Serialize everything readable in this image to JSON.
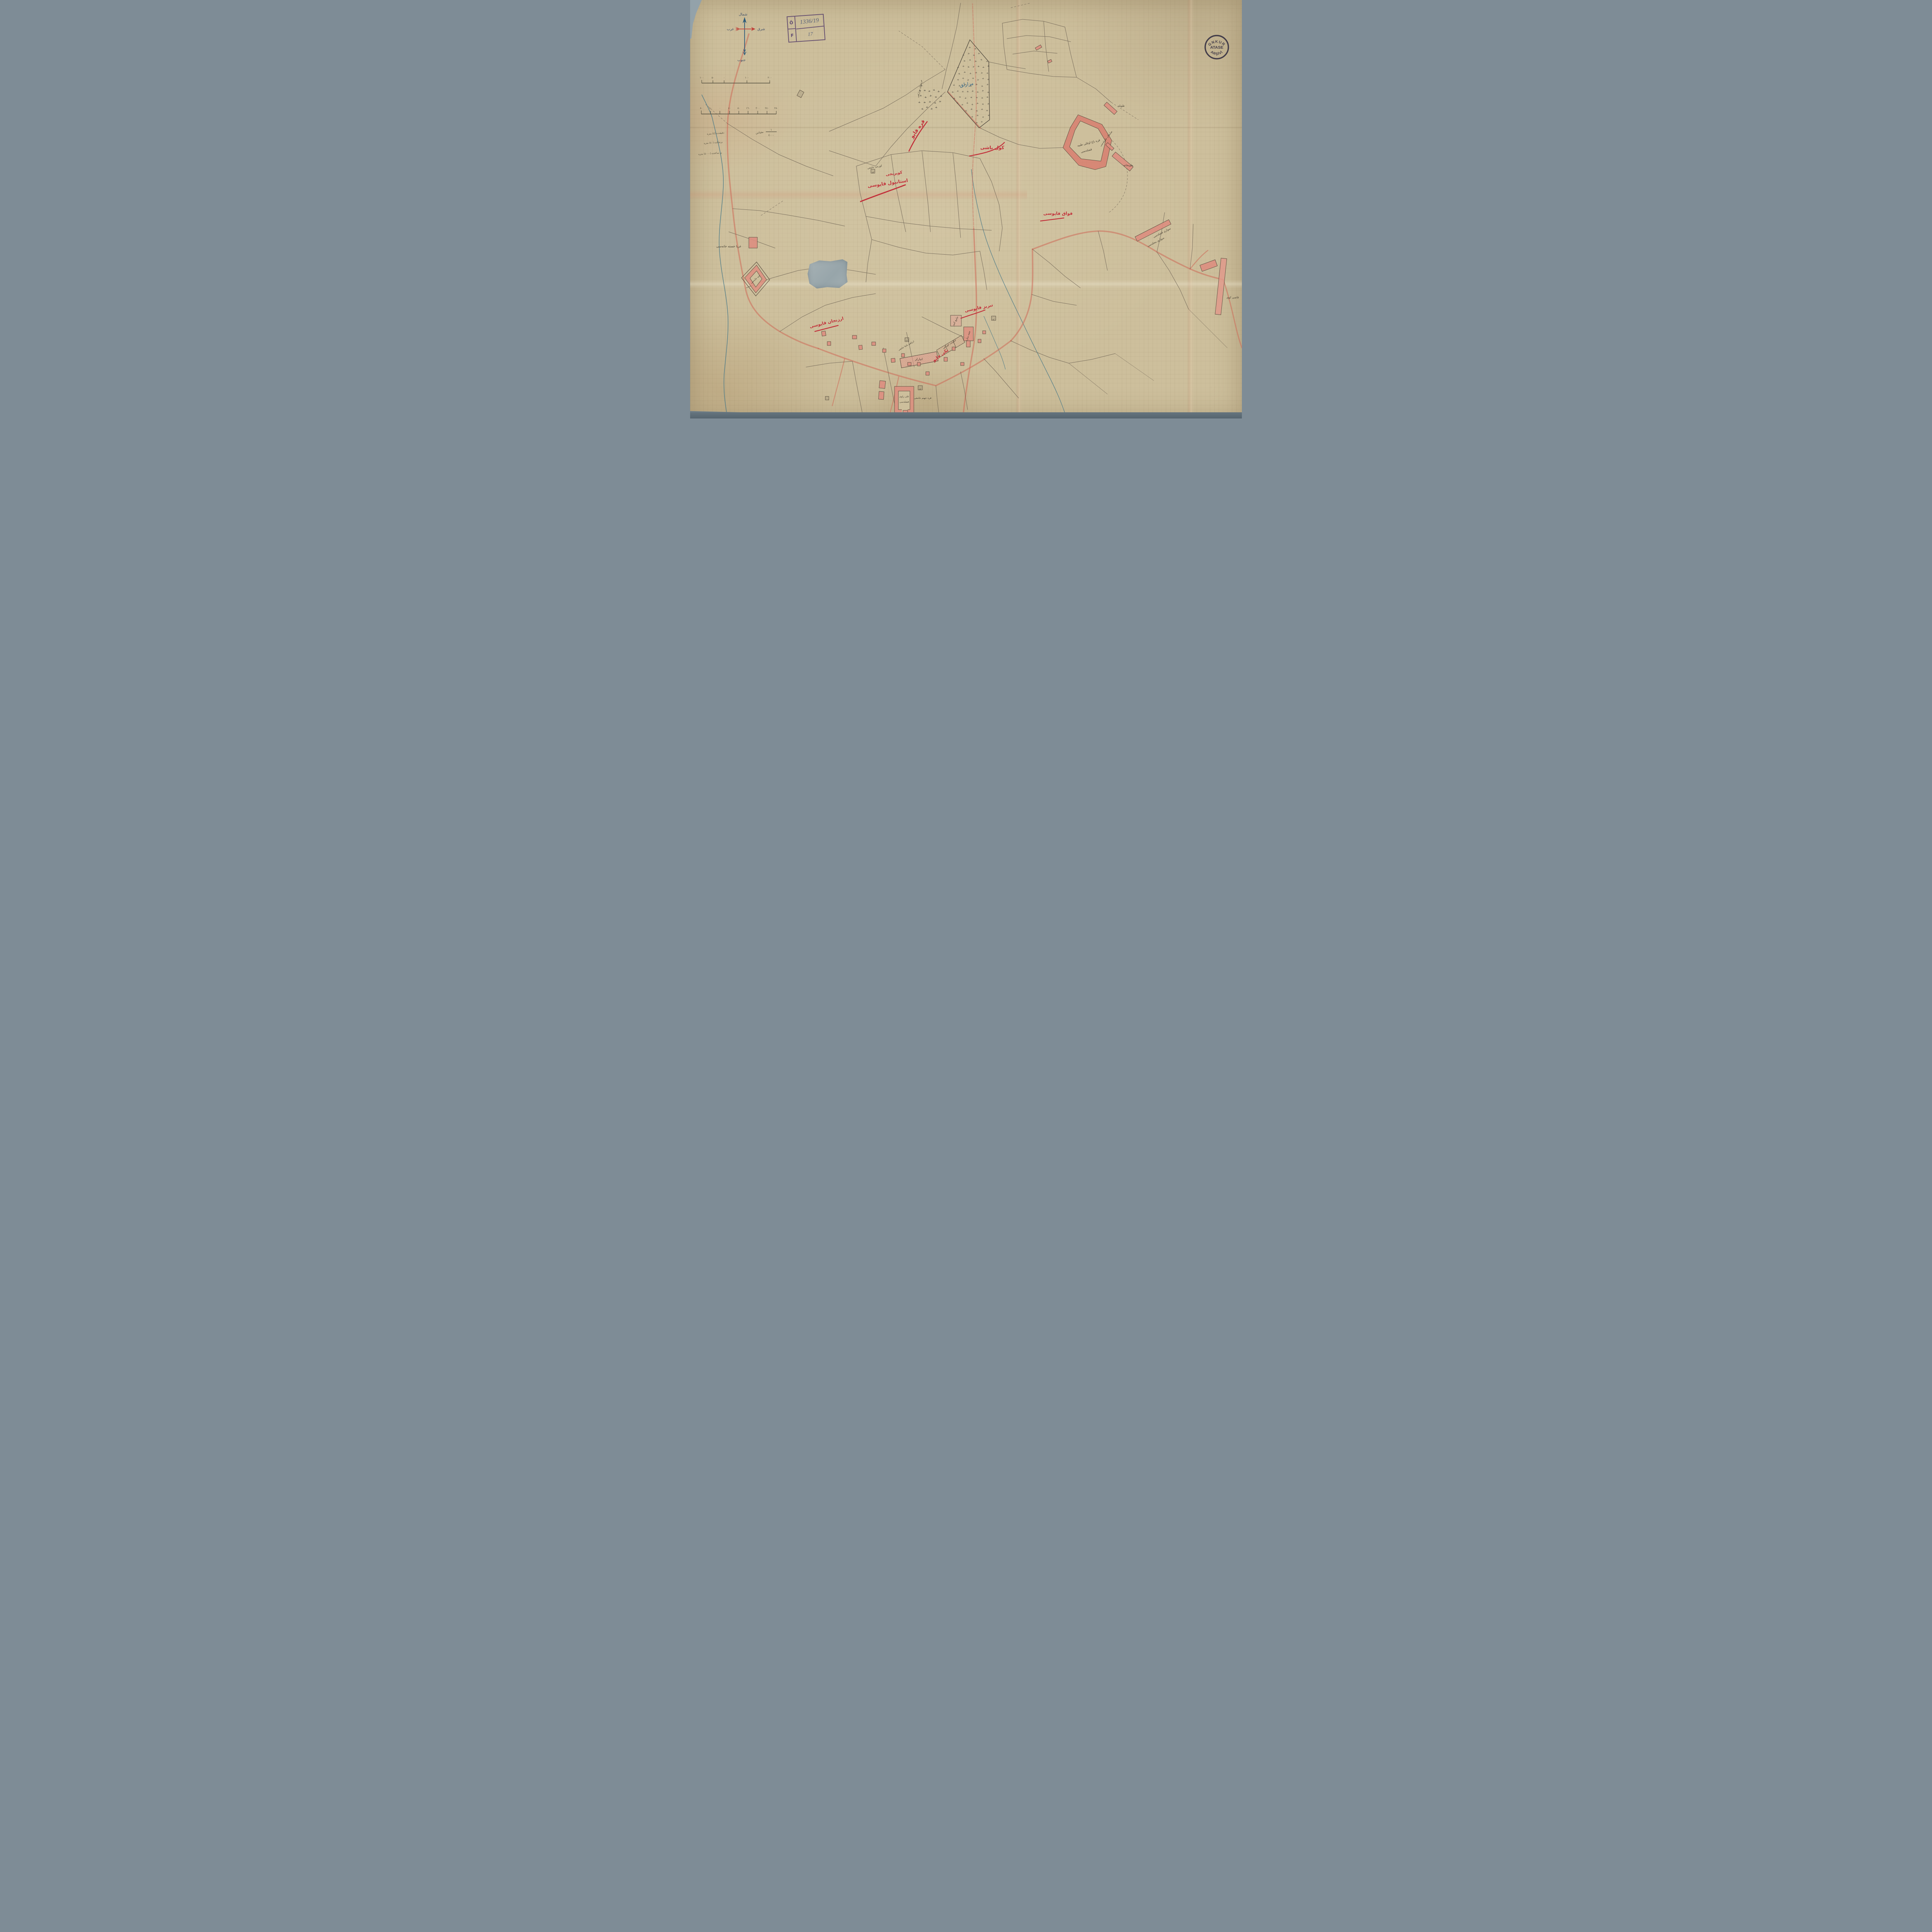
{
  "map": {
    "compass": {
      "north": "شمال",
      "south": "جنوب",
      "east": "شرق",
      "west": "غرب"
    },
    "catalog_stamp": {
      "row1_key": "Ö",
      "row1_value": "1336/19",
      "row2_key": "F",
      "row2_value": "17"
    },
    "archive_stamp": {
      "arc_top": "GNKUR",
      "center": "ATASE",
      "arc_bottom": "ARŞİVİ"
    },
    "scale": {
      "bar1_labels": [
        "١٠٠",
        "٥٠",
        "٠",
        "١٠٠",
        "٢٠٠"
      ],
      "bar2_labels": [
        "٨٠",
        "٤٠",
        "٠",
        "٤٠",
        "٨٠",
        "١٦٠",
        "٢٠٠",
        "٢٤٠",
        "٢٨٠"
      ],
      "ratio_numerator": "١",
      "ratio_denominator": "٤٠٠٠",
      "ratio_caption": "مقياس",
      "notes": [
        "دقيقه‌ده (٤) متره",
        "برنجكده (٤٠) متره",
        "بر ساعتده (٤٠٠٠) متره"
      ]
    },
    "red_labels": {
      "gate_north": "قره قاپو",
      "golbasi": "كول باشى",
      "gate_west_line1": "كوپريجى",
      "gate_west_line2": "استانبول قاپوسى",
      "gate_kavak": "قواق قاپوسى",
      "gate_tebriz": "تبريز قاپوسى",
      "gate_erzincan": "ارزنجان قاپوسى",
      "gate_yeni": "يكى قاپو"
    },
    "black_labels": {
      "hospital": "غربا خسته خانه‌سى",
      "magazine": "جبه خانه‌سى",
      "ali_kisla_line1": "على راوى",
      "ali_kisla_line2": "قشله‌سى",
      "warehouses": "انبارلر",
      "cavalry_line1": "سوارى قشله‌سى",
      "cavalry_line2": "سوارى محله‌سى",
      "stable": "طويله",
      "officers_stable": "ضابطان طويله‌سى",
      "artillery_house": "طوبخانه",
      "grand_mosque": "جامع كبير",
      "twin_minaret": "چفته مناره",
      "kara_cehennem_mosque": "قره جهنم جامعى",
      "barracks_line1": "قره باغ اوغلى طبيه",
      "barracks_line2": "قشله‌سى",
      "government_house": "حكومت قوناغى",
      "kadi_koy": "قاضى كوى",
      "christian_cemetery": "خرستيان مزارلغى",
      "gurcu_mosque": "كورجى جامعى",
      "ibrahim_mosque": "ابراهيم پاشا جامعى"
    },
    "blue_labels": {
      "cemetery": "مزارلق"
    },
    "mosque_marks": [
      "ب",
      "ن",
      "ن",
      "ى"
    ]
  }
}
